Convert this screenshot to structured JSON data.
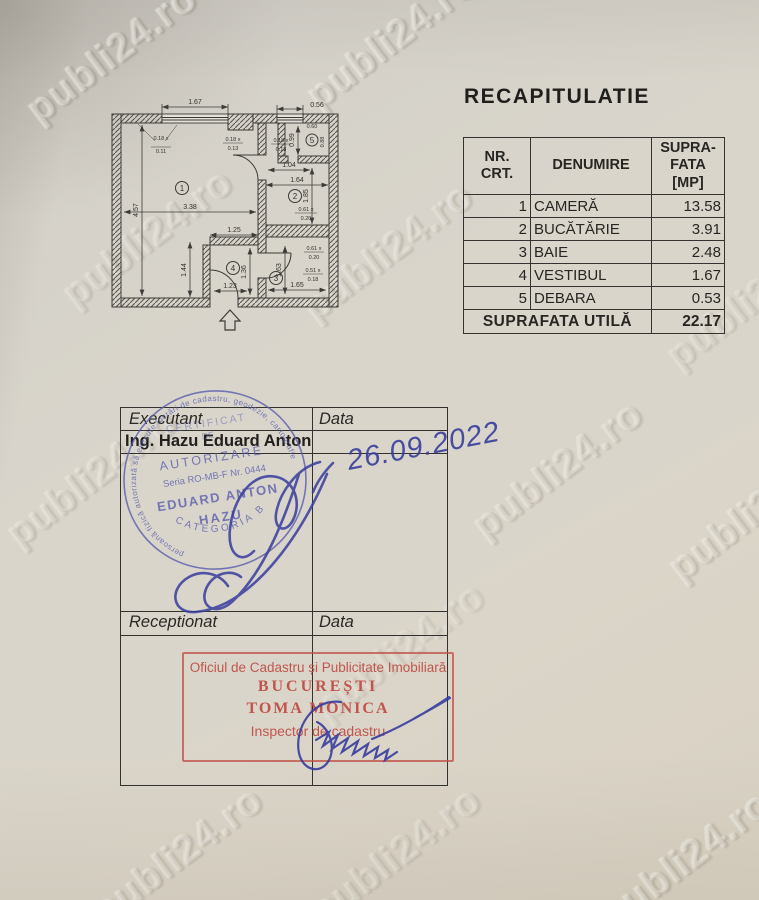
{
  "photo": {
    "watermark_text": "publi24.ro"
  },
  "title": "RECAPITULATIE",
  "table": {
    "header": {
      "col1": "NR.\nCRT.",
      "col2": "DENUMIRE",
      "col3": "SUPRA-\nFATA\n[MP]"
    },
    "rows": [
      {
        "nr": "1",
        "name": "CAMERĂ",
        "area": "13.58"
      },
      {
        "nr": "2",
        "name": "BUCĂTĂRIE",
        "area": "3.91"
      },
      {
        "nr": "3",
        "name": "BAIE",
        "area": "2.48"
      },
      {
        "nr": "4",
        "name": "VESTIBUL",
        "area": "1.67"
      },
      {
        "nr": "5",
        "name": "DEBARA",
        "area": "0.53"
      }
    ],
    "footer": {
      "label": "SUPRAFATA UTILĂ",
      "value": "22.17"
    }
  },
  "plan": {
    "room_labels": [
      "1",
      "2",
      "3",
      "4",
      "5"
    ],
    "dims": {
      "win1": "1.67",
      "win2": "0.56",
      "room1_w": "3.38",
      "room1_h": "4.57",
      "k1": "1.04",
      "k2": "1.64",
      "k3": "1.85",
      "d1": "0.99",
      "d2": "0.60",
      "d3": "0.88",
      "v1": "1.25",
      "v2": "1.23",
      "v3": "1.36",
      "v4": "1.44",
      "b1": "1.63",
      "b2": "1.65",
      "wa1": "0.18 x",
      "wa2": "0.11",
      "wb1": "0.18 x",
      "wb2": "0.13",
      "wc1": "0.18 x",
      "wc2": "0.13",
      "pa1": "0.61 x",
      "pa2": "0.20",
      "pb1": "0.61 x",
      "pb2": "0.20",
      "pc1": "0.51 x",
      "pc2": "0.18"
    }
  },
  "executant": {
    "label": "Executant",
    "date_label": "Data",
    "name": "Ing. Hazu Eduard Anton",
    "handwritten_date": "26.09.2022"
  },
  "receptionat": {
    "label": "Receptionat",
    "date_label": "Data"
  },
  "round_stamp": {
    "ring": "persoană fizică autorizată să execute lucrări de cadastru, geodezie, cartografie",
    "l1": "CERTIFICAT",
    "l2": "DE",
    "l3": "AUTORIZARE",
    "l4": "Seria RO-MB-F Nr. 0444",
    "l5": "EDUARD ANTON",
    "l6": "HAZU",
    "arc": "CATEGORIA B"
  },
  "red_stamp": {
    "l1": "Oficiul de Cadastru și Publicitate Imobiliară",
    "l2": "BUCUREȘTI",
    "l3": "TOMA MONICA",
    "l4": "Inspector de cadastru"
  },
  "colors": {
    "ink_blue": "#383d9e",
    "stamp_blue": "#5a5ead",
    "stamp_red": "#c0534c",
    "paper": "#d8d3c8"
  }
}
